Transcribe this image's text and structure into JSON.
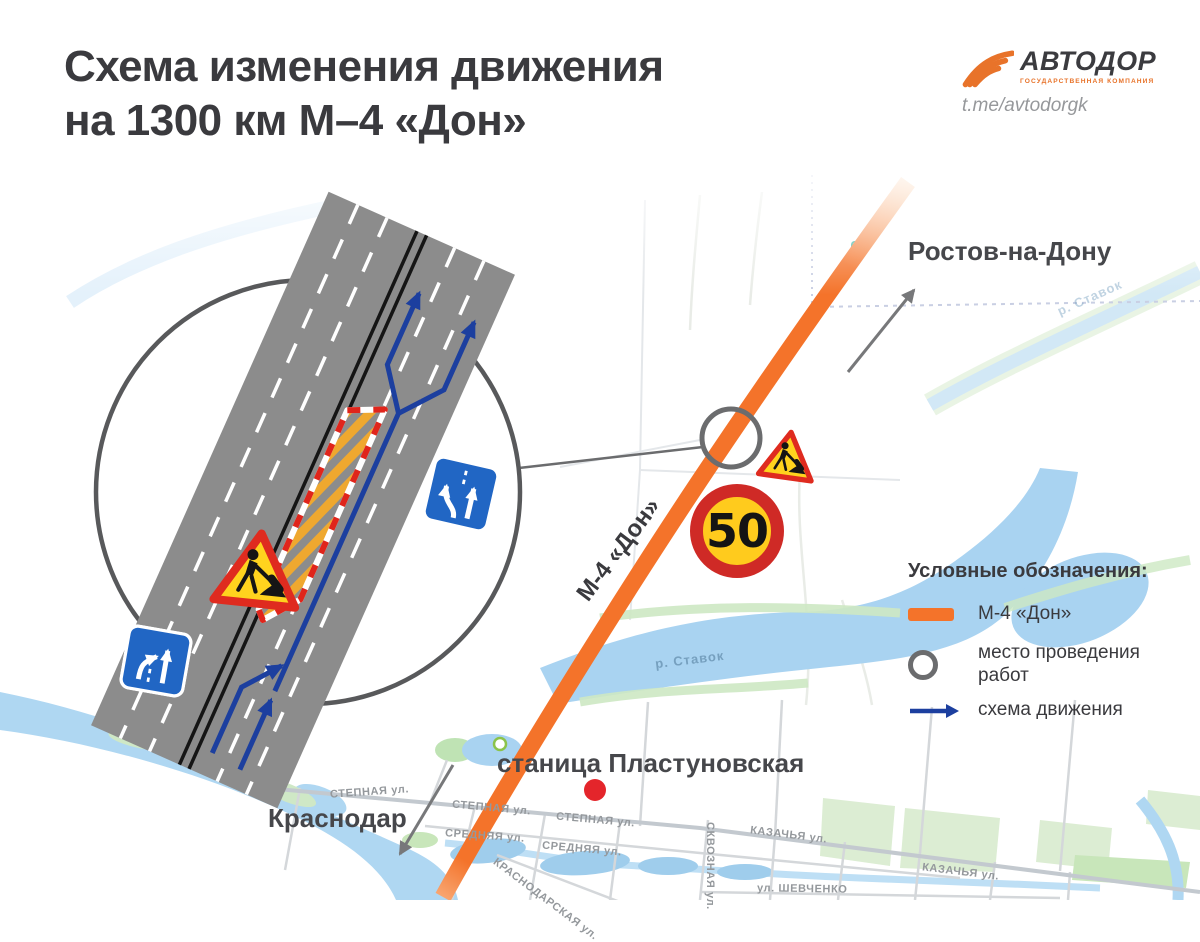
{
  "header": {
    "title_line1": "Схема изменения движения",
    "title_line2": "на 1300 км М–4 «Дон»",
    "logo": {
      "brand": "АВТОДОР",
      "subtitle": "ГОСУДАРСТВЕННАЯ КОМПАНИЯ",
      "telegram": "t.me/avtodorgk",
      "icon": "road-swoosh-icon",
      "accent_color": "#E8732A"
    }
  },
  "map": {
    "city_labels": {
      "rostov": "Ростов-на-Дону",
      "krasnodar": "Краснодар",
      "stanitsa": "станица Пластуновская"
    },
    "highway_label": "М-4 «Дон»",
    "river_label_main": "р. Ставок",
    "river_label_far": "р. Ставок",
    "streets": [
      "СТЕПНАЯ ул.",
      "СТЕПНАЯ ул.",
      "СТЕПНАЯ ул.",
      "СРЕДНЯЯ ул.",
      "СРЕДНЯЯ ул.",
      "КАЗАЧЬЯ ул.",
      "КАЗАЧЬЯ ул.",
      "СКВОЗНАЯ ул.",
      "ул. ШЕВЧЕНКО",
      "КРАСНОДАРСКАЯ ул."
    ],
    "speed_sign_value": "50",
    "icons": {
      "speed_limit": "speed-limit-50-sign",
      "roadworks": "roadworks-sign",
      "work_site_marker": "work-site-circle",
      "direction_arrows": "gray-direction-arrow"
    },
    "colors": {
      "highway": "#F4732A",
      "water": "#A9D3F1",
      "green": "#D9EDD3",
      "marker_ring": "#6B6C6E",
      "detour_blue": "#1C3F9F",
      "sign_red": "#CF2A26",
      "sign_yellow": "#FFCB1D",
      "road_gray": "#8C8C8C"
    }
  },
  "inset": {
    "icons": {
      "roadworks_sign": "roadworks-sign",
      "lane_merge_sign": "lane-merge-sign",
      "lane_shift_sign": "lane-shift-sign",
      "work_zone": "hatched-work-zone",
      "detour_path": "blue-detour-arrows"
    }
  },
  "legend": {
    "title": "Условные обозначения:",
    "items": [
      {
        "icon": "highway-line-swatch",
        "label": "М-4 «Дон»"
      },
      {
        "icon": "work-site-ring",
        "label": "место проведения работ"
      },
      {
        "icon": "direction-arrow",
        "label": "схема движения"
      }
    ]
  }
}
